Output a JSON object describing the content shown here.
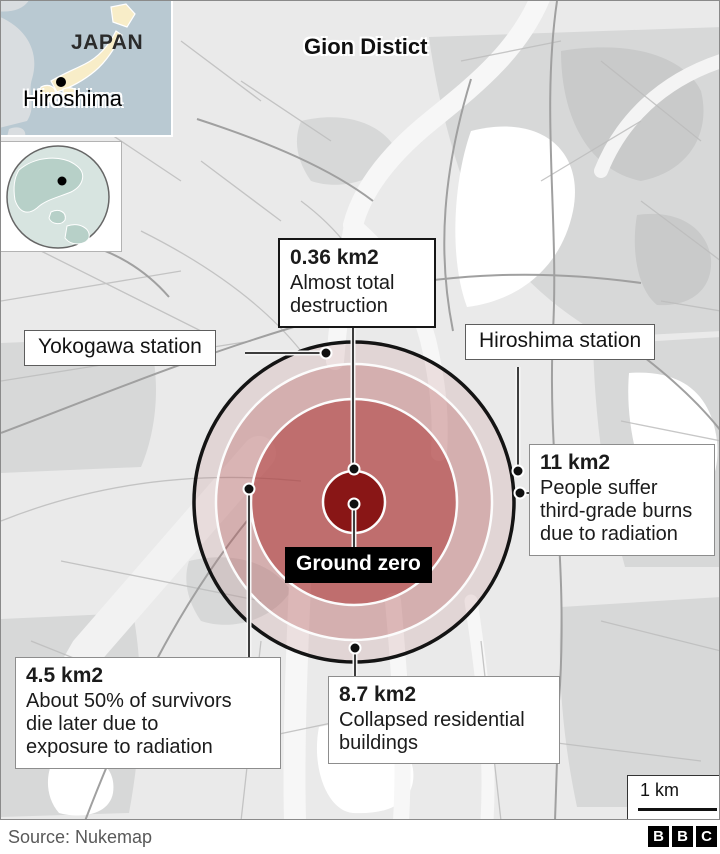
{
  "insets": {
    "japan": {
      "country_label": "JAPAN",
      "city_label": "Hiroshima"
    },
    "globe": {
      "marker": "Hiroshima location"
    }
  },
  "map": {
    "district_label": "Gion Distict",
    "ground_zero_label": "Ground zero",
    "stations": {
      "yokogawa": "Yokogawa station",
      "hiroshima": "Hiroshima station"
    },
    "zones": {
      "destruction": {
        "area": "0.36 km2",
        "desc": "Almost total\ndestruction"
      },
      "survivors": {
        "area": "4.5 km2",
        "desc": "About 50% of survivors\ndie later due to\nexposure to radiation"
      },
      "collapsed": {
        "area": "8.7 km2",
        "desc": "Collapsed residential\nbuildings"
      },
      "burns": {
        "area": "11 km2",
        "desc": "People suffer\nthird-grade burns\ndue to radiation"
      }
    },
    "scale_label": "1 km"
  },
  "footer": {
    "source": "Source: Nukemap",
    "logo": [
      "B",
      "B",
      "C"
    ]
  },
  "colors": {
    "core_red": "#861111",
    "zone_inner": "rgba(168,38,38,0.47)",
    "zone_mid": "rgba(180,80,80,0.28)",
    "zone_outer": "rgba(185,115,115,0.17)",
    "outer_ring": "#141414",
    "inset_sea": "#b9c9d2",
    "inset_land": "#f8edc8"
  }
}
